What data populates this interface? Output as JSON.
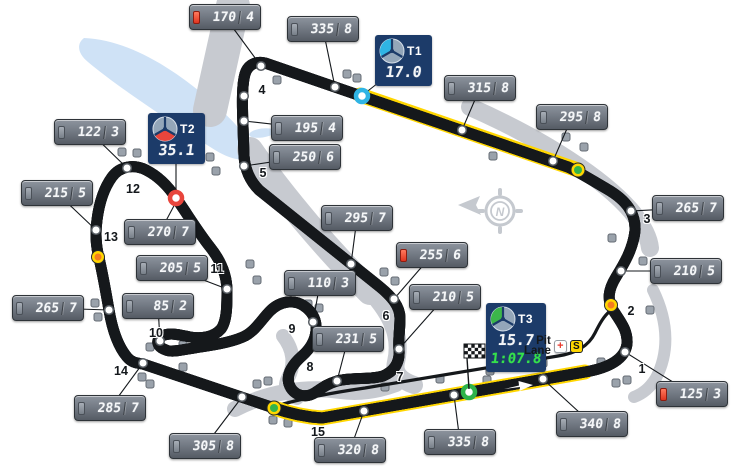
{
  "track_map": {
    "compass_letter": "N",
    "pit": {
      "line1": "Pit",
      "line2": "Lane",
      "medical_symbol": "+",
      "speed_limit_symbol": "S"
    },
    "colors": {
      "track_tan": "#c59e66",
      "zone_yellow": "#ffd600",
      "sector1_accent": "#2fb4e4",
      "sector2_accent": "#e8453c",
      "sector3_accent": "#3cb64a",
      "brake_red": "#e8432f",
      "lap_green": "#35e14b",
      "old_track_gray": "#c7cad0",
      "lake_blue": "#cfe2f6"
    }
  },
  "sectors": [
    {
      "label": "T1",
      "time": "17.0",
      "accent": "#2fb4e4"
    },
    {
      "label": "T2",
      "time": "35.1",
      "accent": "#e8453c"
    },
    {
      "label": "T3",
      "time": "15.7",
      "lap_time": "1:07.8",
      "accent": "#3cb64a"
    }
  ],
  "speed_badges": [
    {
      "speed": "170",
      "gear": "4",
      "brake": true,
      "x": 225,
      "y": 17,
      "dot_x": 261,
      "dot_y": 66
    },
    {
      "speed": "335",
      "gear": "8",
      "brake": false,
      "x": 323,
      "y": 29,
      "dot_x": 335,
      "dot_y": 87
    },
    {
      "speed": "315",
      "gear": "8",
      "brake": false,
      "x": 480,
      "y": 88,
      "dot_x": 462,
      "dot_y": 130
    },
    {
      "speed": "295",
      "gear": "8",
      "brake": false,
      "x": 572,
      "y": 117,
      "dot_x": 553,
      "dot_y": 161
    },
    {
      "speed": "265",
      "gear": "7",
      "brake": false,
      "x": 688,
      "y": 208,
      "dot_x": 631,
      "dot_y": 211
    },
    {
      "speed": "210",
      "gear": "5",
      "brake": false,
      "x": 686,
      "y": 271,
      "dot_x": 621,
      "dot_y": 271
    },
    {
      "speed": "125",
      "gear": "3",
      "brake": true,
      "x": 692,
      "y": 394,
      "dot_x": 625,
      "dot_y": 352
    },
    {
      "speed": "340",
      "gear": "8",
      "brake": false,
      "x": 592,
      "y": 424,
      "dot_x": 543,
      "dot_y": 379
    },
    {
      "speed": "335",
      "gear": "8",
      "brake": false,
      "x": 460,
      "y": 442,
      "dot_x": 454,
      "dot_y": 395
    },
    {
      "speed": "320",
      "gear": "8",
      "brake": false,
      "x": 350,
      "y": 450,
      "dot_x": 364,
      "dot_y": 411
    },
    {
      "speed": "305",
      "gear": "8",
      "brake": false,
      "x": 205,
      "y": 446,
      "dot_x": 242,
      "dot_y": 397
    },
    {
      "speed": "285",
      "gear": "7",
      "brake": false,
      "x": 110,
      "y": 408,
      "dot_x": 143,
      "dot_y": 363
    },
    {
      "speed": "265",
      "gear": "7",
      "brake": false,
      "x": 48,
      "y": 308,
      "dot_x": 109,
      "dot_y": 310
    },
    {
      "speed": "215",
      "gear": "5",
      "brake": false,
      "x": 57,
      "y": 193,
      "dot_x": 96,
      "dot_y": 230
    },
    {
      "speed": "122",
      "gear": "3",
      "brake": false,
      "x": 90,
      "y": 132,
      "dot_x": 127,
      "dot_y": 168
    },
    {
      "speed": "270",
      "gear": "7",
      "brake": false,
      "x": 160,
      "y": 232,
      "dot_x": 176,
      "dot_y": 202,
      "no_dot": true
    },
    {
      "speed": "205",
      "gear": "5",
      "brake": false,
      "x": 172,
      "y": 268,
      "dot_x": 227,
      "dot_y": 289
    },
    {
      "speed": "85",
      "gear": "2",
      "brake": false,
      "x": 158,
      "y": 306,
      "dot_x": 160,
      "dot_y": 341
    },
    {
      "speed": "110",
      "gear": "3",
      "brake": false,
      "x": 320,
      "y": 283,
      "dot_x": 313,
      "dot_y": 322
    },
    {
      "speed": "231",
      "gear": "5",
      "brake": false,
      "x": 348,
      "y": 339,
      "dot_x": 337,
      "dot_y": 381
    },
    {
      "speed": "295",
      "gear": "7",
      "brake": false,
      "x": 357,
      "y": 218,
      "dot_x": 351,
      "dot_y": 264
    },
    {
      "speed": "255",
      "gear": "6",
      "brake": true,
      "x": 432,
      "y": 255,
      "dot_x": 394,
      "dot_y": 299
    },
    {
      "speed": "210",
      "gear": "5",
      "brake": false,
      "x": 445,
      "y": 297,
      "dot_x": 399,
      "dot_y": 349
    },
    {
      "speed": "195",
      "gear": "4",
      "brake": false,
      "x": 307,
      "y": 128,
      "dot_x": 244,
      "dot_y": 121
    },
    {
      "speed": "250",
      "gear": "6",
      "brake": false,
      "x": 305,
      "y": 157,
      "dot_x": 244,
      "dot_y": 166
    }
  ],
  "turn_labels": [
    {
      "n": "1",
      "x": 642,
      "y": 369
    },
    {
      "n": "2",
      "x": 631,
      "y": 311
    },
    {
      "n": "3",
      "x": 647,
      "y": 219
    },
    {
      "n": "4",
      "x": 262,
      "y": 90
    },
    {
      "n": "5",
      "x": 263,
      "y": 173
    },
    {
      "n": "6",
      "x": 386,
      "y": 316
    },
    {
      "n": "7",
      "x": 400,
      "y": 377
    },
    {
      "n": "8",
      "x": 310,
      "y": 367
    },
    {
      "n": "9",
      "x": 292,
      "y": 329
    },
    {
      "n": "10",
      "x": 156,
      "y": 333
    },
    {
      "n": "11",
      "x": 217,
      "y": 269
    },
    {
      "n": "12",
      "x": 133,
      "y": 189
    },
    {
      "n": "13",
      "x": 111,
      "y": 237
    },
    {
      "n": "14",
      "x": 121,
      "y": 371
    },
    {
      "n": "15",
      "x": 318,
      "y": 432
    }
  ],
  "markers": {
    "sector_points": [
      {
        "color": "#2fb4e4",
        "x": 362,
        "y": 96
      },
      {
        "color": "#e8453c",
        "x": 176,
        "y": 198
      },
      {
        "color": "#2db34a",
        "x": 469,
        "y": 392
      }
    ],
    "zone_lights": [
      {
        "x": 578,
        "y": 170
      },
      {
        "x": 274,
        "y": 408
      }
    ],
    "spots": [
      {
        "x": 98,
        "y": 257
      },
      {
        "x": 611,
        "y": 305
      }
    ],
    "extra_dots": [
      {
        "x": 244,
        "y": 96
      }
    ]
  },
  "map_features": {
    "posts": [
      [
        277,
        80
      ],
      [
        347,
        74
      ],
      [
        357,
        78
      ],
      [
        493,
        156
      ],
      [
        566,
        137
      ],
      [
        584,
        147
      ],
      [
        612,
        238
      ],
      [
        643,
        261
      ],
      [
        650,
        310
      ],
      [
        601,
        362
      ],
      [
        616,
        383
      ],
      [
        627,
        380
      ],
      [
        122,
        152
      ],
      [
        137,
        153
      ],
      [
        210,
        157
      ],
      [
        216,
        171
      ],
      [
        250,
        264
      ],
      [
        257,
        280
      ],
      [
        384,
        272
      ],
      [
        395,
        281
      ],
      [
        95,
        303
      ],
      [
        98,
        317
      ],
      [
        150,
        347
      ],
      [
        183,
        345
      ],
      [
        142,
        377
      ],
      [
        150,
        384
      ],
      [
        183,
        367
      ],
      [
        308,
        304
      ],
      [
        319,
        308
      ],
      [
        257,
        384
      ],
      [
        268,
        381
      ],
      [
        273,
        420
      ],
      [
        288,
        423
      ],
      [
        487,
        380
      ],
      [
        385,
        387
      ],
      [
        440,
        379
      ],
      [
        490,
        371
      ],
      [
        543,
        363
      ]
    ]
  }
}
